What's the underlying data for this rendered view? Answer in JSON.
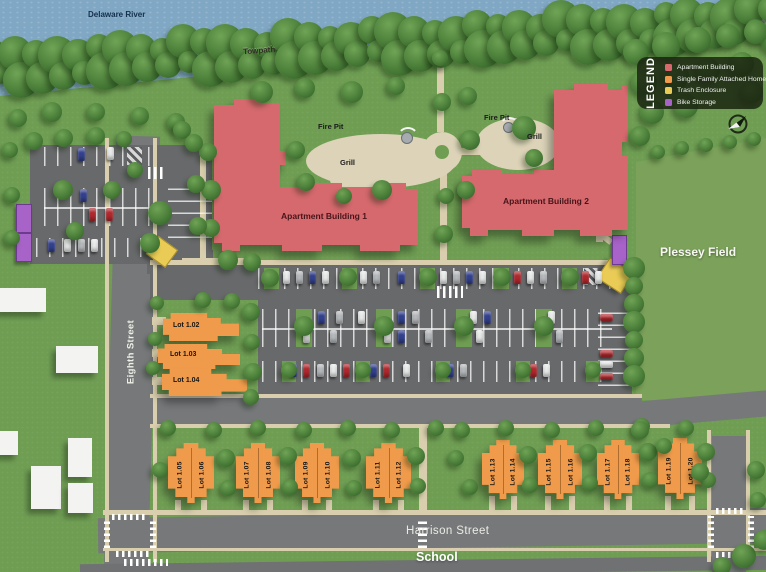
{
  "labels": {
    "river": "Delaware River",
    "towpath": "Towpath",
    "eighth_street": "Eighth Street",
    "harrison_street": "Harrison Street",
    "school": "School",
    "plessey_field": "Plessey Field",
    "apartment1": "Apartment Building 1",
    "apartment2": "Apartment Building 2",
    "fire_pit": "Fire Pit",
    "grill": "Grill"
  },
  "legend": {
    "title": "LEGEND",
    "items": [
      {
        "label": "Apartment Building",
        "color": "#d5696d"
      },
      {
        "label": "Single Family Attached Homes",
        "color": "#f09b4b"
      },
      {
        "label": "Trash Enclosure",
        "color": "#e9cb55"
      },
      {
        "label": "Bike Storage",
        "color": "#a763c8"
      }
    ]
  },
  "lots": {
    "left": [
      "Lot 1.02",
      "Lot 1.03",
      "Lot 1.04"
    ],
    "bottom": [
      "Lot 1.05",
      "Lot 1.06",
      "Lot 1.07",
      "Lot 1.08",
      "Lot 1.09",
      "Lot 1.10",
      "Lot 1.11",
      "Lot 1.12",
      "Lot 1.13",
      "Lot 1.14",
      "Lot 1.15",
      "Lot 1.16",
      "Lot 1.17",
      "Lot 1.18",
      "Lot 1.19",
      "Lot 1.20"
    ]
  }
}
